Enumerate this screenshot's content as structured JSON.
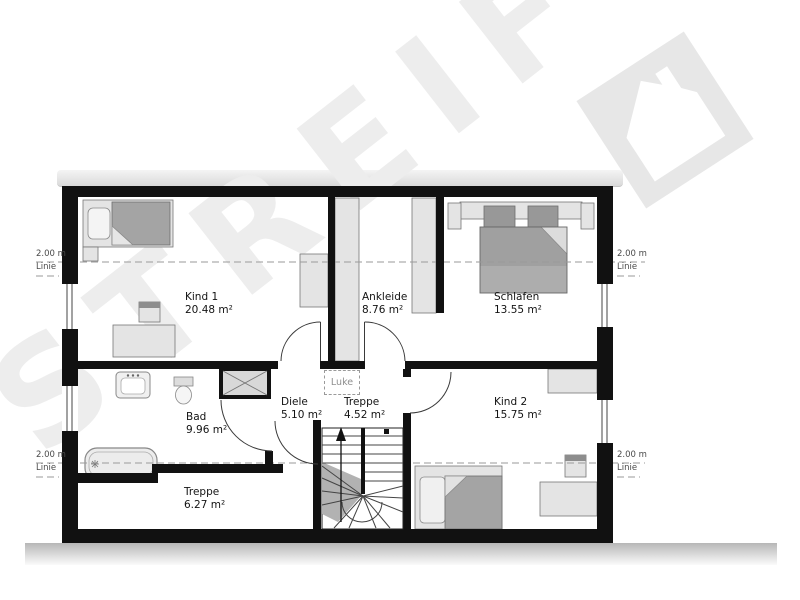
{
  "watermark": {
    "text": "STREIF",
    "logo": "house-logo"
  },
  "rooms": [
    {
      "id": "kind1",
      "name": "Kind 1",
      "area": "20.48 m²"
    },
    {
      "id": "ankleide",
      "name": "Ankleide",
      "area": "8.76 m²"
    },
    {
      "id": "schlafen",
      "name": "Schlafen",
      "area": "13.55 m²"
    },
    {
      "id": "bad",
      "name": "Bad",
      "area": "9.96 m²"
    },
    {
      "id": "diele",
      "name": "Diele",
      "area": "5.10 m²"
    },
    {
      "id": "treppe-upper",
      "name": "Treppe",
      "area": "4.52 m²"
    },
    {
      "id": "kind2",
      "name": "Kind 2",
      "area": "15.75 m²"
    },
    {
      "id": "treppe-lower",
      "name": "Treppe",
      "area": "6.27 m²"
    }
  ],
  "annotations": {
    "luke": "Luke",
    "height_label": {
      "value": "2.00 m",
      "name": "Linie"
    }
  },
  "colors": {
    "wall": "#111111",
    "furniture_light": "#e4e4e4",
    "furniture_dark": "#a4a4a4",
    "watermark": "#ededed",
    "dashed_line": "#9a9a9a",
    "label_text": "#131313",
    "side_label_text": "#4a4a4a"
  }
}
